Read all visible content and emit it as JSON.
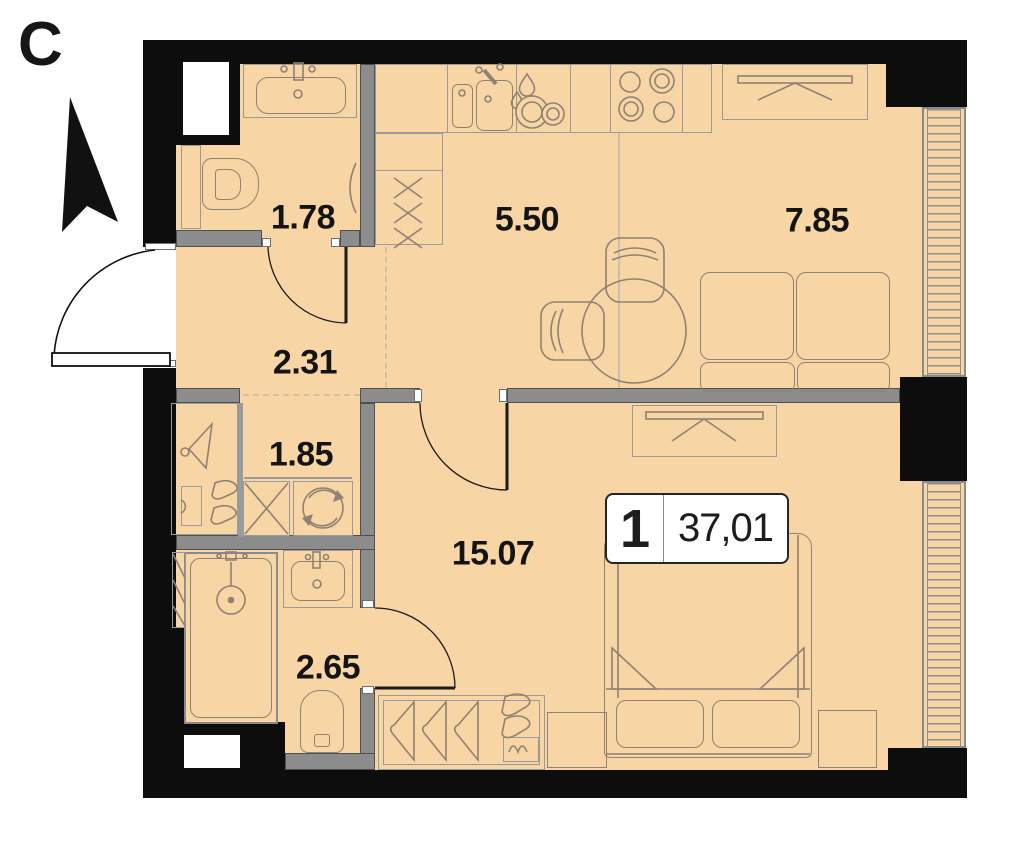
{
  "north_label": "С",
  "unit": {
    "rooms_count": "1",
    "area": "37,01"
  },
  "rooms": [
    {
      "name": "bathroom-top",
      "area": "1.78"
    },
    {
      "name": "kitchen",
      "area": "5.50"
    },
    {
      "name": "living-room",
      "area": "7.85"
    },
    {
      "name": "hallway",
      "area": "2.31"
    },
    {
      "name": "wardrobe-laundry",
      "area": "1.85"
    },
    {
      "name": "bedroom",
      "area": "15.07"
    },
    {
      "name": "bathroom-bottom",
      "area": "2.65"
    }
  ],
  "icons": [
    "north-arrow-icon",
    "entrance-door-arc",
    "toilet-icon",
    "sink-icon",
    "shower-icon",
    "washing-machine-icon",
    "stove-icon",
    "kitchen-sink-icon",
    "dish-drying-icon",
    "bed-icon",
    "sofa-icon",
    "dining-table-icon",
    "chair-icon",
    "wardrobe-rail-icon",
    "hanger-icon",
    "towel-radiator-icon",
    "window-glazing",
    "vent-shaft"
  ],
  "colors": {
    "floor": "#f8d5a4",
    "exterior_wall": "#0d0d0d",
    "partition": "#8c8c8c",
    "furniture_line": "#8f8173",
    "zone_dashed": "#d2c0a2",
    "label_text": "#141414"
  }
}
